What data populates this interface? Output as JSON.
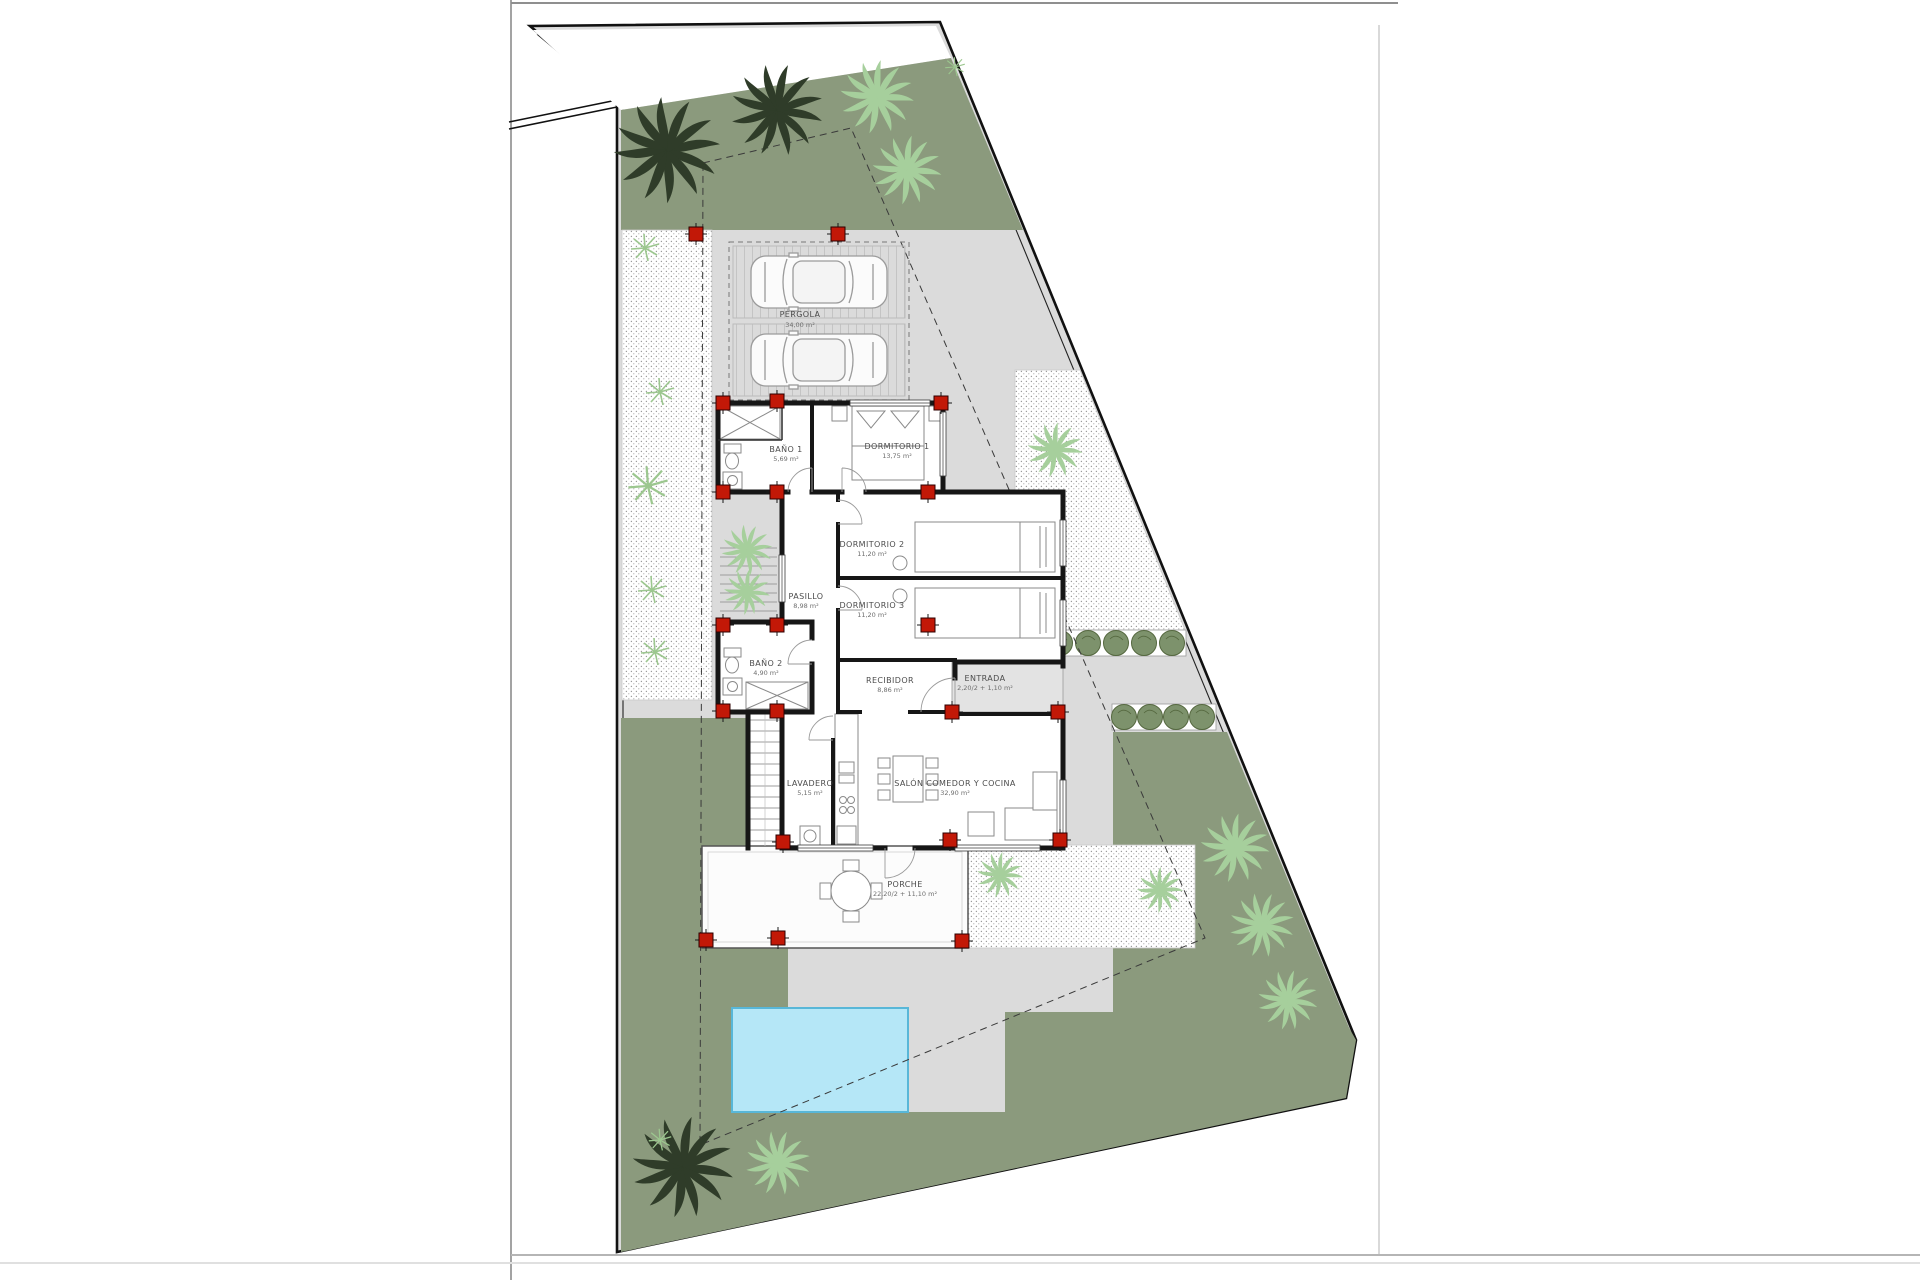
{
  "plan_title": "Villa site plan",
  "rooms": {
    "pergola": {
      "name": "PÉRGOLA",
      "area": "34,00 m²"
    },
    "bano1": {
      "name": "BAÑO 1",
      "area": "5,69 m²"
    },
    "dormitorio1": {
      "name": "DORMITORIO 1",
      "area": "13,75 m²"
    },
    "dormitorio2": {
      "name": "DORMITORIO 2",
      "area": "11,20 m²"
    },
    "dormitorio3": {
      "name": "DORMITORIO 3",
      "area": "11,20 m²"
    },
    "pasillo": {
      "name": "PASILLO",
      "area": "8,98 m²"
    },
    "bano2": {
      "name": "BAÑO 2",
      "area": "4,90 m²"
    },
    "recibidor": {
      "name": "RECIBIDOR",
      "area": "8,86 m²"
    },
    "entrada": {
      "name": "ENTRADA",
      "area": "2,20/2 + 1,10 m²"
    },
    "lavadero": {
      "name": "LAVADERO",
      "area": "5,15 m²"
    },
    "salon": {
      "name": "SALÓN COMEDOR Y COCINA",
      "area": "32,90 m²"
    },
    "porche": {
      "name": "PORCHE",
      "area": "22,20/2 + 11,10 m²"
    }
  },
  "colors": {
    "garden_green": "#8b9a7d",
    "paving_gray": "#dbdbdb",
    "pool_fill": "#b5e7f7",
    "pool_edge": "#58b7d8",
    "marker_red": "#c21807",
    "hedge_green": "#7d926c"
  }
}
